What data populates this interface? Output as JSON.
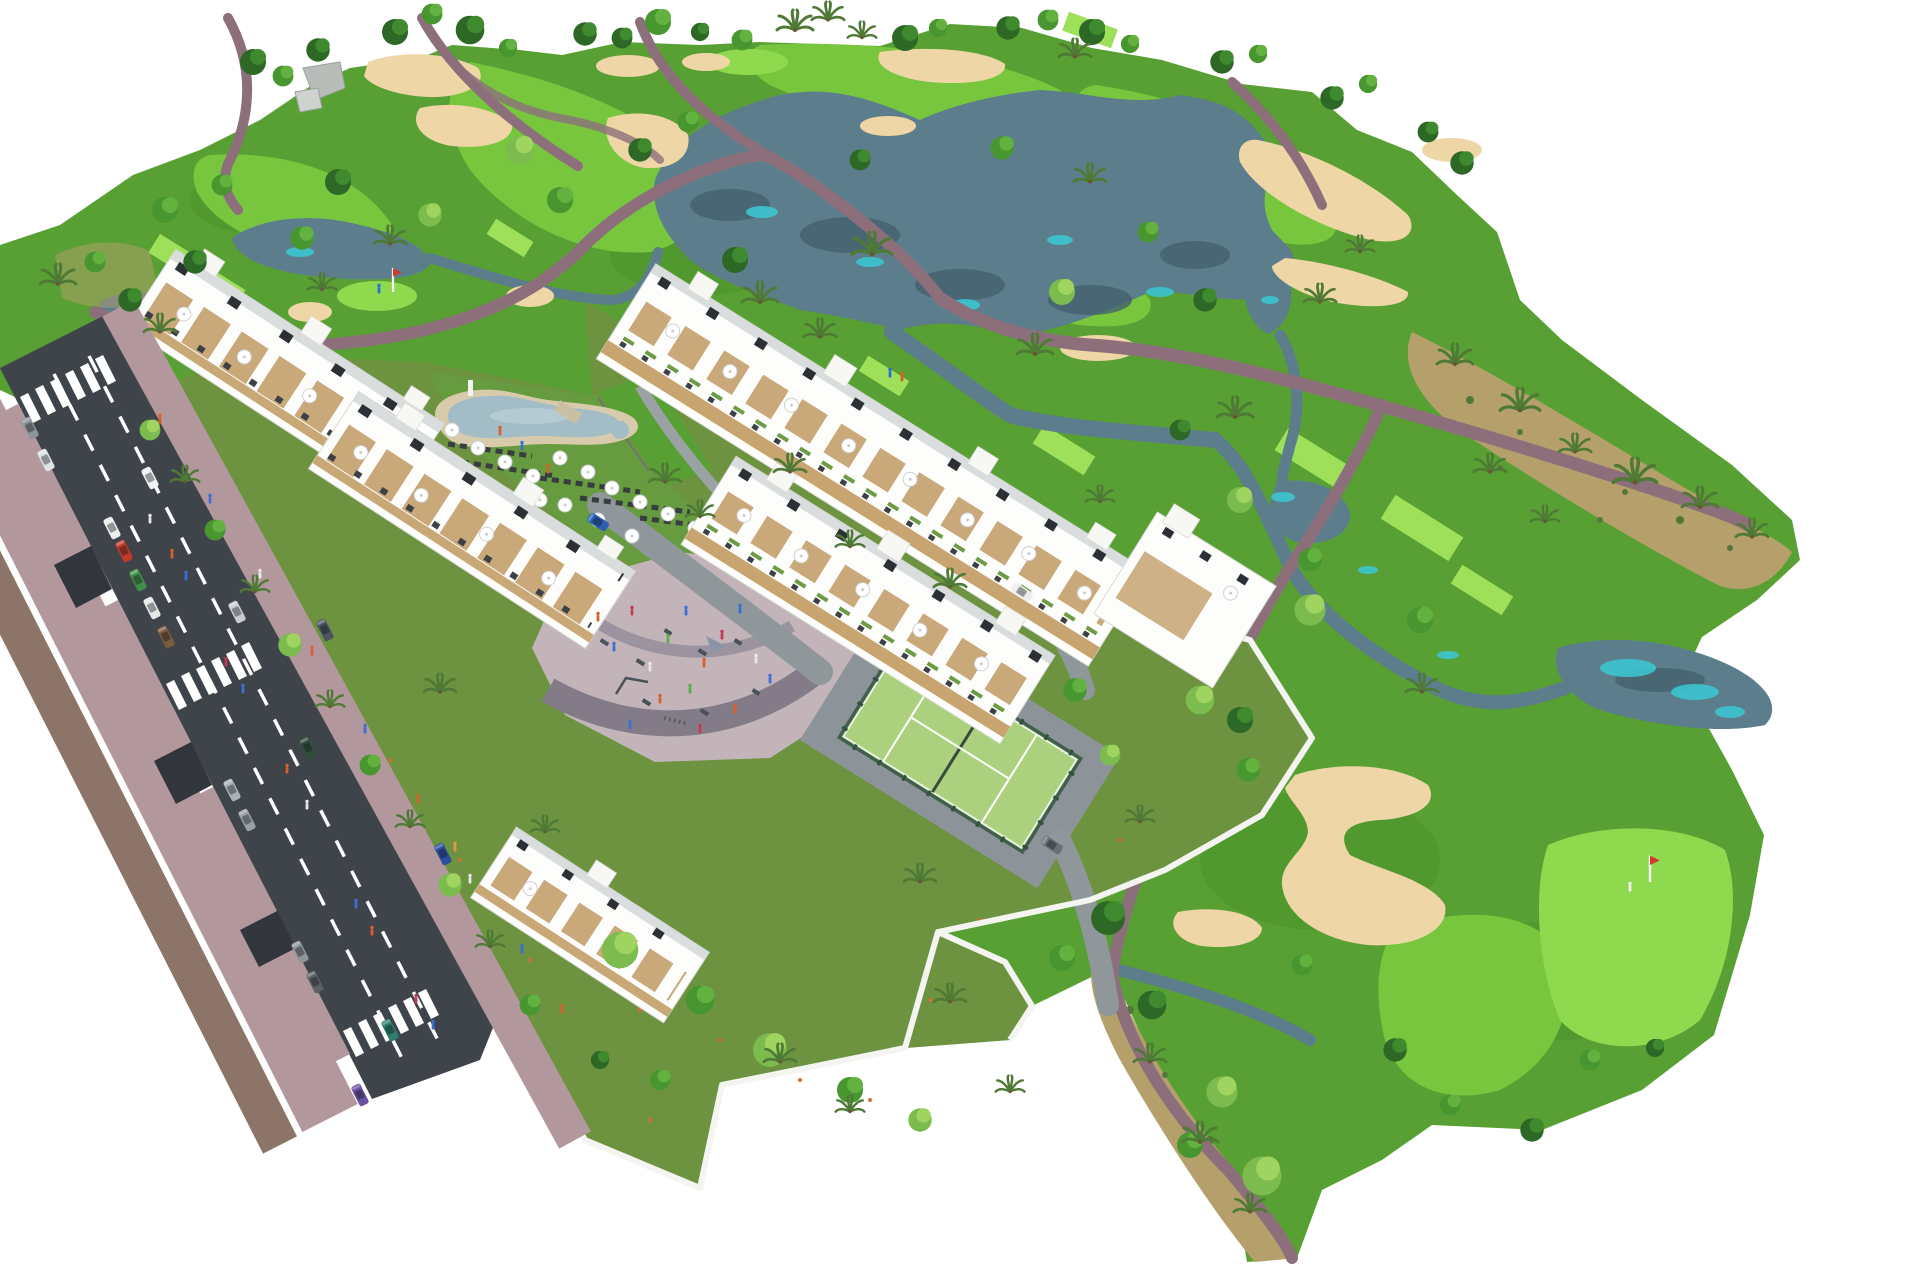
{
  "image": {
    "kind": "aerial 3D architectural render",
    "subject": "residential apartment complex beside a golf course",
    "width_px": 1920,
    "height_px": 1280,
    "background": "#ffffff",
    "text_content": "none (no visible text in image)"
  },
  "colors": {
    "background": "#ffffff",
    "rough": "#58a033",
    "rough_dark": "#4a8f2c",
    "fairway": "#78c63e",
    "green": "#8fd94f",
    "tee": "#9fe05a",
    "lake_water": "#5c7d8c",
    "lake_dark": "#44616d",
    "lake_teal": "#3cc4cf",
    "bunker_sand": "#eed6a6",
    "cart_path": "#8d6f7c",
    "scrub": "#b5a06b",
    "road_asphalt": "#3f444b",
    "lane_marking": "#ffffff",
    "sidewalk": "#b2989c",
    "curb_strip": "#8d7468",
    "parcel_lawn": "#6d9340",
    "pool_lawn": "#679b40",
    "pool_water": "#a3bdc7",
    "pool_deck": "#d8cbab",
    "plaza_paving": "#c3b4ba",
    "plaza_path": "#837c88",
    "padel_surface": "#abd17e",
    "padel_fence": "#41604c",
    "building_white": "#fdfdfc",
    "building_tan": "#c9a877",
    "building_panel": "#2c3034",
    "wall_white": "#f4f4f1",
    "tree_dark": "#2d6827",
    "tree_mid": "#47962f",
    "tree_light": "#7cbb4d",
    "palm": "#4f7a36",
    "umbrella": "#ffffff",
    "lounger": "#34393c",
    "concrete_path": "#9aa2a3",
    "drive_gray": "#8d9499"
  },
  "objects": {
    "golf_course": {
      "label": "golf course",
      "lakes": 6,
      "sand_bunkers": 14,
      "putting_greens_with_flag": 2,
      "tee_boxes": 9,
      "flags": 2,
      "golfer_figures": 2
    },
    "road": {
      "label": "access road",
      "lanes": 3,
      "zebra_crossings": 3,
      "parked_cars": 11,
      "moving_cars": 6
    },
    "residence": {
      "label": "apartment development",
      "building_blocks": 6,
      "swimming_pool": 1,
      "padel_court": 1,
      "playground_plaza": 1,
      "pool_umbrellas": 16
    },
    "vegetation": {
      "trees": "many round canopy trees",
      "palms": "many palm trees"
    }
  }
}
